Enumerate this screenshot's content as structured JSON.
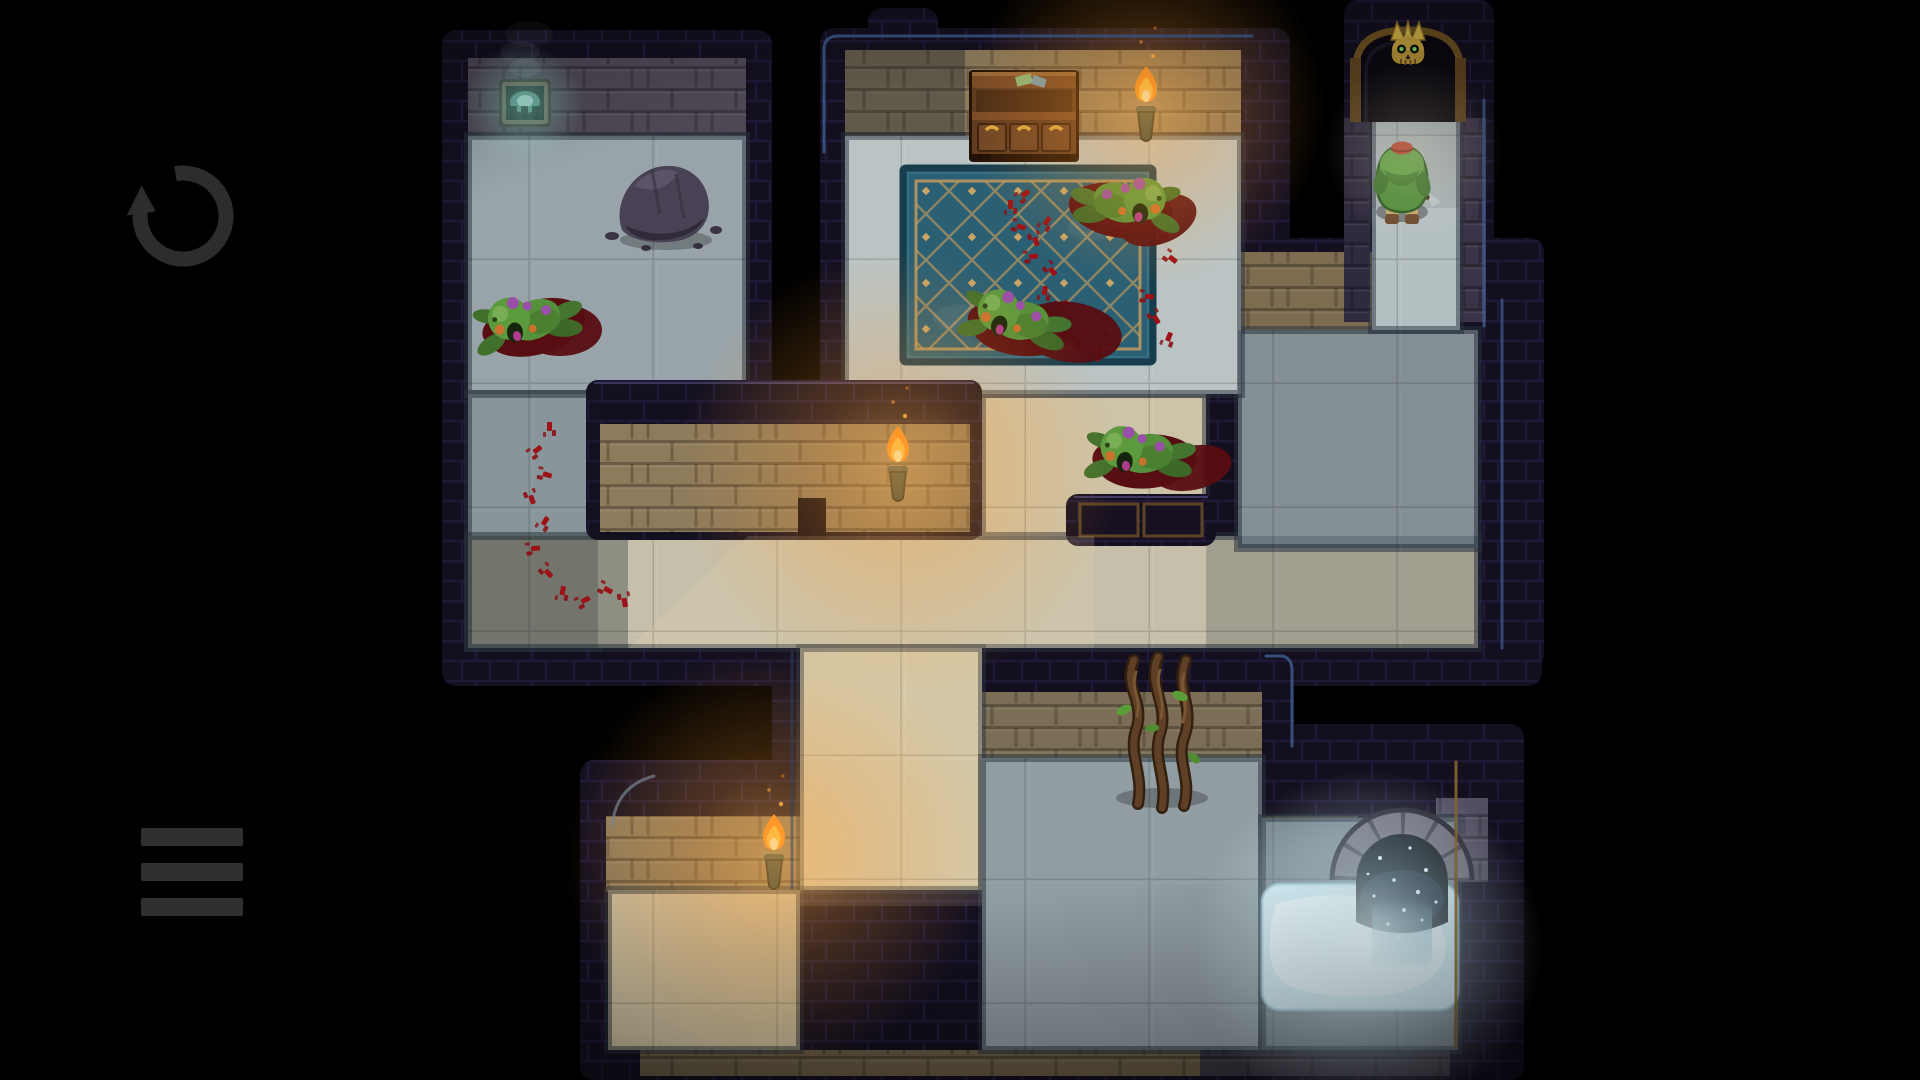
{
  "scene": {
    "background": "#000000"
  },
  "ui": {
    "restart_button": {
      "icon": "restart-icon",
      "color": "#2d2d2d",
      "cx": 183,
      "cy": 216,
      "r": 43
    },
    "menu_button": {
      "icon": "hamburger-menu-icon",
      "color": "#303030",
      "x": 141,
      "y": 828,
      "bar_w": 102,
      "bar_h": 18,
      "gap": 35
    }
  },
  "palette": {
    "background": "#000000",
    "wall_dark": "#130f1f",
    "brick_lit": "#8d7b5c",
    "brick_dim": "#4e4855",
    "floor_cool": "#b0bdc0",
    "floor_warm": "#d2c5a4",
    "rug_base": "#2a5f74",
    "rug_line": "#c09a5e",
    "blood_dark": "#570d11",
    "blood_red": "#9c1216",
    "goblin_green": "#55913a",
    "torch_flame": "#ffc23e",
    "gold": "#d9a53f",
    "pool_glow": "#eafcff",
    "edge_blue": "#3e5e92",
    "dim": "#121a26",
    "shaft": "#ecdcae",
    "ui_icon": "#2d2d2d"
  },
  "map": {
    "wall_blobs": [
      [
        442,
        30,
        330,
        400
      ],
      [
        442,
        360,
        186,
        322
      ],
      [
        442,
        508,
        1100,
        178
      ],
      [
        820,
        28,
        470,
        405
      ],
      [
        954,
        360,
        280,
        300
      ],
      [
        1234,
        238,
        310,
        430
      ],
      [
        1344,
        0,
        150,
        340
      ],
      [
        772,
        620,
        240,
        460
      ],
      [
        580,
        760,
        440,
        320
      ],
      [
        954,
        636,
        340,
        444
      ],
      [
        1234,
        724,
        290,
        356
      ],
      [
        868,
        8,
        70,
        60
      ]
    ],
    "wall_faces": [
      {
        "x": 468,
        "y": 58,
        "w": 278,
        "h": 78,
        "tone": "#4e4855"
      },
      {
        "x": 845,
        "y": 50,
        "w": 396,
        "h": 86,
        "tone": "#8d7b5c"
      },
      {
        "x": 1236,
        "y": 252,
        "w": 142,
        "h": 78,
        "tone": "#7d6c50"
      },
      {
        "x": 606,
        "y": 816,
        "w": 196,
        "h": 76,
        "tone": "#8d7b5c"
      },
      {
        "x": 982,
        "y": 692,
        "w": 280,
        "h": 66,
        "tone": "#7c6e56"
      },
      {
        "x": 1262,
        "y": 816,
        "w": 96,
        "h": 74,
        "tone": "#5f5648"
      },
      {
        "x": 1436,
        "y": 798,
        "w": 52,
        "h": 84,
        "tone": "#555064"
      },
      {
        "x": 1456,
        "y": 118,
        "w": 30,
        "h": 204,
        "tone": "#3b3348"
      },
      {
        "x": 1344,
        "y": 118,
        "w": 26,
        "h": 204,
        "tone": "#302a3e"
      },
      {
        "x": 640,
        "y": 1050,
        "w": 560,
        "h": 26,
        "tone": "#6a5d48"
      },
      {
        "x": 1200,
        "y": 1050,
        "w": 250,
        "h": 26,
        "tone": "#3c3642"
      }
    ],
    "floors": [
      {
        "id": "room-top-left",
        "x": 468,
        "y": 136,
        "w": 278,
        "h": 258,
        "tone": "#b0bdc0"
      },
      {
        "id": "corridor-left",
        "x": 468,
        "y": 394,
        "w": 130,
        "h": 254,
        "tone": "#aab8bb"
      },
      {
        "id": "corridor-main",
        "x": 468,
        "y": 536,
        "w": 1010,
        "h": 112,
        "tone": "#c6c0ab"
      },
      {
        "id": "passage-center-down",
        "x": 982,
        "y": 394,
        "w": 224,
        "h": 142,
        "tone": "#cdc3a8"
      },
      {
        "id": "room-right",
        "x": 1238,
        "y": 330,
        "w": 240,
        "h": 218,
        "tone": "#a7b4b8"
      },
      {
        "id": "alcove-exit",
        "x": 1372,
        "y": 108,
        "w": 88,
        "h": 222,
        "tone": "#b4bfc2"
      },
      {
        "id": "room-center",
        "x": 845,
        "y": 136,
        "w": 396,
        "h": 258,
        "tone": "#bac4c4"
      },
      {
        "id": "passage-lower-down",
        "x": 800,
        "y": 648,
        "w": 182,
        "h": 242,
        "tone": "#d2c5a4"
      },
      {
        "id": "corridor-bottom-left",
        "x": 608,
        "y": 890,
        "w": 192,
        "h": 160,
        "tone": "#cfc2a2"
      },
      {
        "id": "corridor-bottom-mid",
        "x": 982,
        "y": 758,
        "w": 280,
        "h": 292,
        "tone": "#aab7ba"
      },
      {
        "id": "corridor-bottom-right",
        "x": 1262,
        "y": 818,
        "w": 196,
        "h": 232,
        "tone": "#9aa9ae"
      }
    ],
    "islands": [
      {
        "outer": [
          586,
          380,
          396,
          160
        ],
        "face": [
          600,
          424,
          370,
          108
        ],
        "niche": [
          798,
          498,
          28,
          42
        ],
        "panels": null
      },
      {
        "outer": [
          1066,
          494,
          150,
          52
        ],
        "face": null,
        "niche": null,
        "panels": [
          [
            1080,
            504,
            58,
            32
          ],
          [
            1144,
            504,
            58,
            32
          ]
        ]
      }
    ],
    "light_shafts": [
      {
        "points": [
          628,
          648,
          748,
          536,
          1094,
          536,
          1094,
          648
        ],
        "opacity": 0.16
      },
      {
        "points": [
          800,
          648,
          982,
          648,
          982,
          906,
          800,
          906
        ],
        "opacity": 0.13
      }
    ],
    "dim_overlays": [
      [
        468,
        136,
        278,
        258,
        0.15
      ],
      [
        468,
        394,
        130,
        254,
        0.22
      ],
      [
        468,
        536,
        160,
        112,
        0.3
      ],
      [
        1206,
        536,
        272,
        112,
        0.2
      ],
      [
        1238,
        330,
        240,
        218,
        0.24
      ],
      [
        982,
        758,
        280,
        292,
        0.16
      ],
      [
        1262,
        818,
        196,
        232,
        0.26
      ],
      [
        845,
        50,
        120,
        86,
        0.35
      ],
      [
        1372,
        108,
        88,
        100,
        0.1
      ]
    ],
    "edge_highlights": [
      {
        "d": "M824,152 V50 Q824,36 838,36 H1252",
        "color": "#3e5e92",
        "opacity": 0.8
      },
      {
        "d": "M1484,100 V326",
        "color": "#3e5e92",
        "opacity": 0.8
      },
      {
        "d": "M1502,300 V648",
        "color": "#3a5688",
        "opacity": 0.8
      },
      {
        "d": "M1266,656 H1282 Q1292,658 1292,670 V746",
        "color": "#3e5e92",
        "opacity": 0.8
      },
      {
        "d": "M1456,762 V1046",
        "color": "#8a6a32",
        "opacity": 0.85
      },
      {
        "d": "M612,826 Q616,786 654,776",
        "color": "#78828e",
        "opacity": 0.7
      },
      {
        "d": "M792,652 V888",
        "color": "#2e4668",
        "opacity": 0.5
      }
    ]
  },
  "entities": [
    {
      "type": "plaque",
      "name": "wall-vent-plaque",
      "x": 502,
      "y": 82
    },
    {
      "type": "rock",
      "name": "rock-pile",
      "x": 664,
      "y": 204
    },
    {
      "type": "blood-pool",
      "name": "blood-pool",
      "x": 560,
      "y": 330,
      "rx": 42,
      "ry": 26,
      "rot": 0
    },
    {
      "type": "goblin",
      "name": "goblin-corpse-1",
      "x": 526,
      "y": 320,
      "rot": -16,
      "flip": false
    },
    {
      "type": "dresser",
      "name": "wooden-dresser",
      "x": 972,
      "y": 72
    },
    {
      "type": "torch",
      "name": "wall-torch-top",
      "x": 1146,
      "y": 96
    },
    {
      "type": "rug",
      "name": "blue-carpet",
      "x": 903,
      "y": 168
    },
    {
      "type": "blood-prints",
      "name": "bloody-footprints-carpet",
      "points": [
        [
          1010,
          206
        ],
        [
          1024,
          194
        ],
        [
          1020,
          226
        ],
        [
          1036,
          240
        ],
        [
          1046,
          222
        ],
        [
          1032,
          256
        ],
        [
          1052,
          270
        ],
        [
          1044,
          292
        ],
        [
          1062,
          304
        ],
        [
          1058,
          330
        ],
        [
          1078,
          342
        ],
        [
          1098,
          352
        ],
        [
          1148,
          296
        ],
        [
          1156,
          318
        ],
        [
          1168,
          338
        ],
        [
          1162,
          236
        ],
        [
          1172,
          258
        ]
      ]
    },
    {
      "type": "blood-pool",
      "name": "blood-pool",
      "x": 1158,
      "y": 220,
      "rx": 40,
      "ry": 24,
      "rot": -20
    },
    {
      "type": "goblin",
      "name": "goblin-corpse-2",
      "x": 1128,
      "y": 202,
      "rot": -10,
      "flip": true
    },
    {
      "type": "blood-pool",
      "name": "blood-pool",
      "x": 1070,
      "y": 332,
      "rx": 52,
      "ry": 30,
      "rot": 8
    },
    {
      "type": "goblin",
      "name": "goblin-corpse-3",
      "x": 1014,
      "y": 318,
      "rot": 6,
      "flip": false
    },
    {
      "type": "blood-pool",
      "name": "blood-pool",
      "x": 1192,
      "y": 468,
      "rx": 40,
      "ry": 22,
      "rot": -12
    },
    {
      "type": "goblin",
      "name": "goblin-corpse-4",
      "x": 1138,
      "y": 452,
      "rot": -4,
      "flip": false
    },
    {
      "type": "blood-prints",
      "name": "bloody-footprints-corridor",
      "points": [
        [
          549,
          428
        ],
        [
          536,
          450
        ],
        [
          546,
          474
        ],
        [
          532,
          498
        ],
        [
          544,
          522
        ],
        [
          534,
          548
        ],
        [
          548,
          572
        ],
        [
          562,
          592
        ],
        [
          584,
          600
        ],
        [
          607,
          589
        ],
        [
          625,
          601
        ]
      ]
    },
    {
      "type": "torch",
      "name": "wall-torch-middle",
      "x": 898,
      "y": 456
    },
    {
      "type": "torch",
      "name": "wall-torch-bottom",
      "x": 774,
      "y": 844
    },
    {
      "type": "door",
      "name": "skull-gate",
      "x": 1352,
      "y": 12
    },
    {
      "type": "player",
      "name": "player-character",
      "x": 1402,
      "y": 178
    },
    {
      "type": "vines",
      "name": "dead-vines",
      "x": 1164,
      "y": 732
    },
    {
      "type": "pool",
      "name": "glowing-pool",
      "x": 1262,
      "y": 884
    },
    {
      "type": "waterfall",
      "name": "waterfall-arch",
      "x": 1402,
      "y": 818
    }
  ],
  "glows": [
    {
      "x": 1146,
      "y": 108,
      "r": 180,
      "kind": "torch"
    },
    {
      "x": 898,
      "y": 470,
      "r": 220,
      "kind": "torch"
    },
    {
      "x": 774,
      "y": 858,
      "r": 210,
      "kind": "torch"
    },
    {
      "x": 1368,
      "y": 946,
      "r": 175,
      "kind": "pool"
    },
    {
      "x": 524,
      "y": 104,
      "r": 60,
      "kind": "teal"
    },
    {
      "x": 1414,
      "y": 150,
      "r": 90,
      "kind": "soft"
    }
  ]
}
